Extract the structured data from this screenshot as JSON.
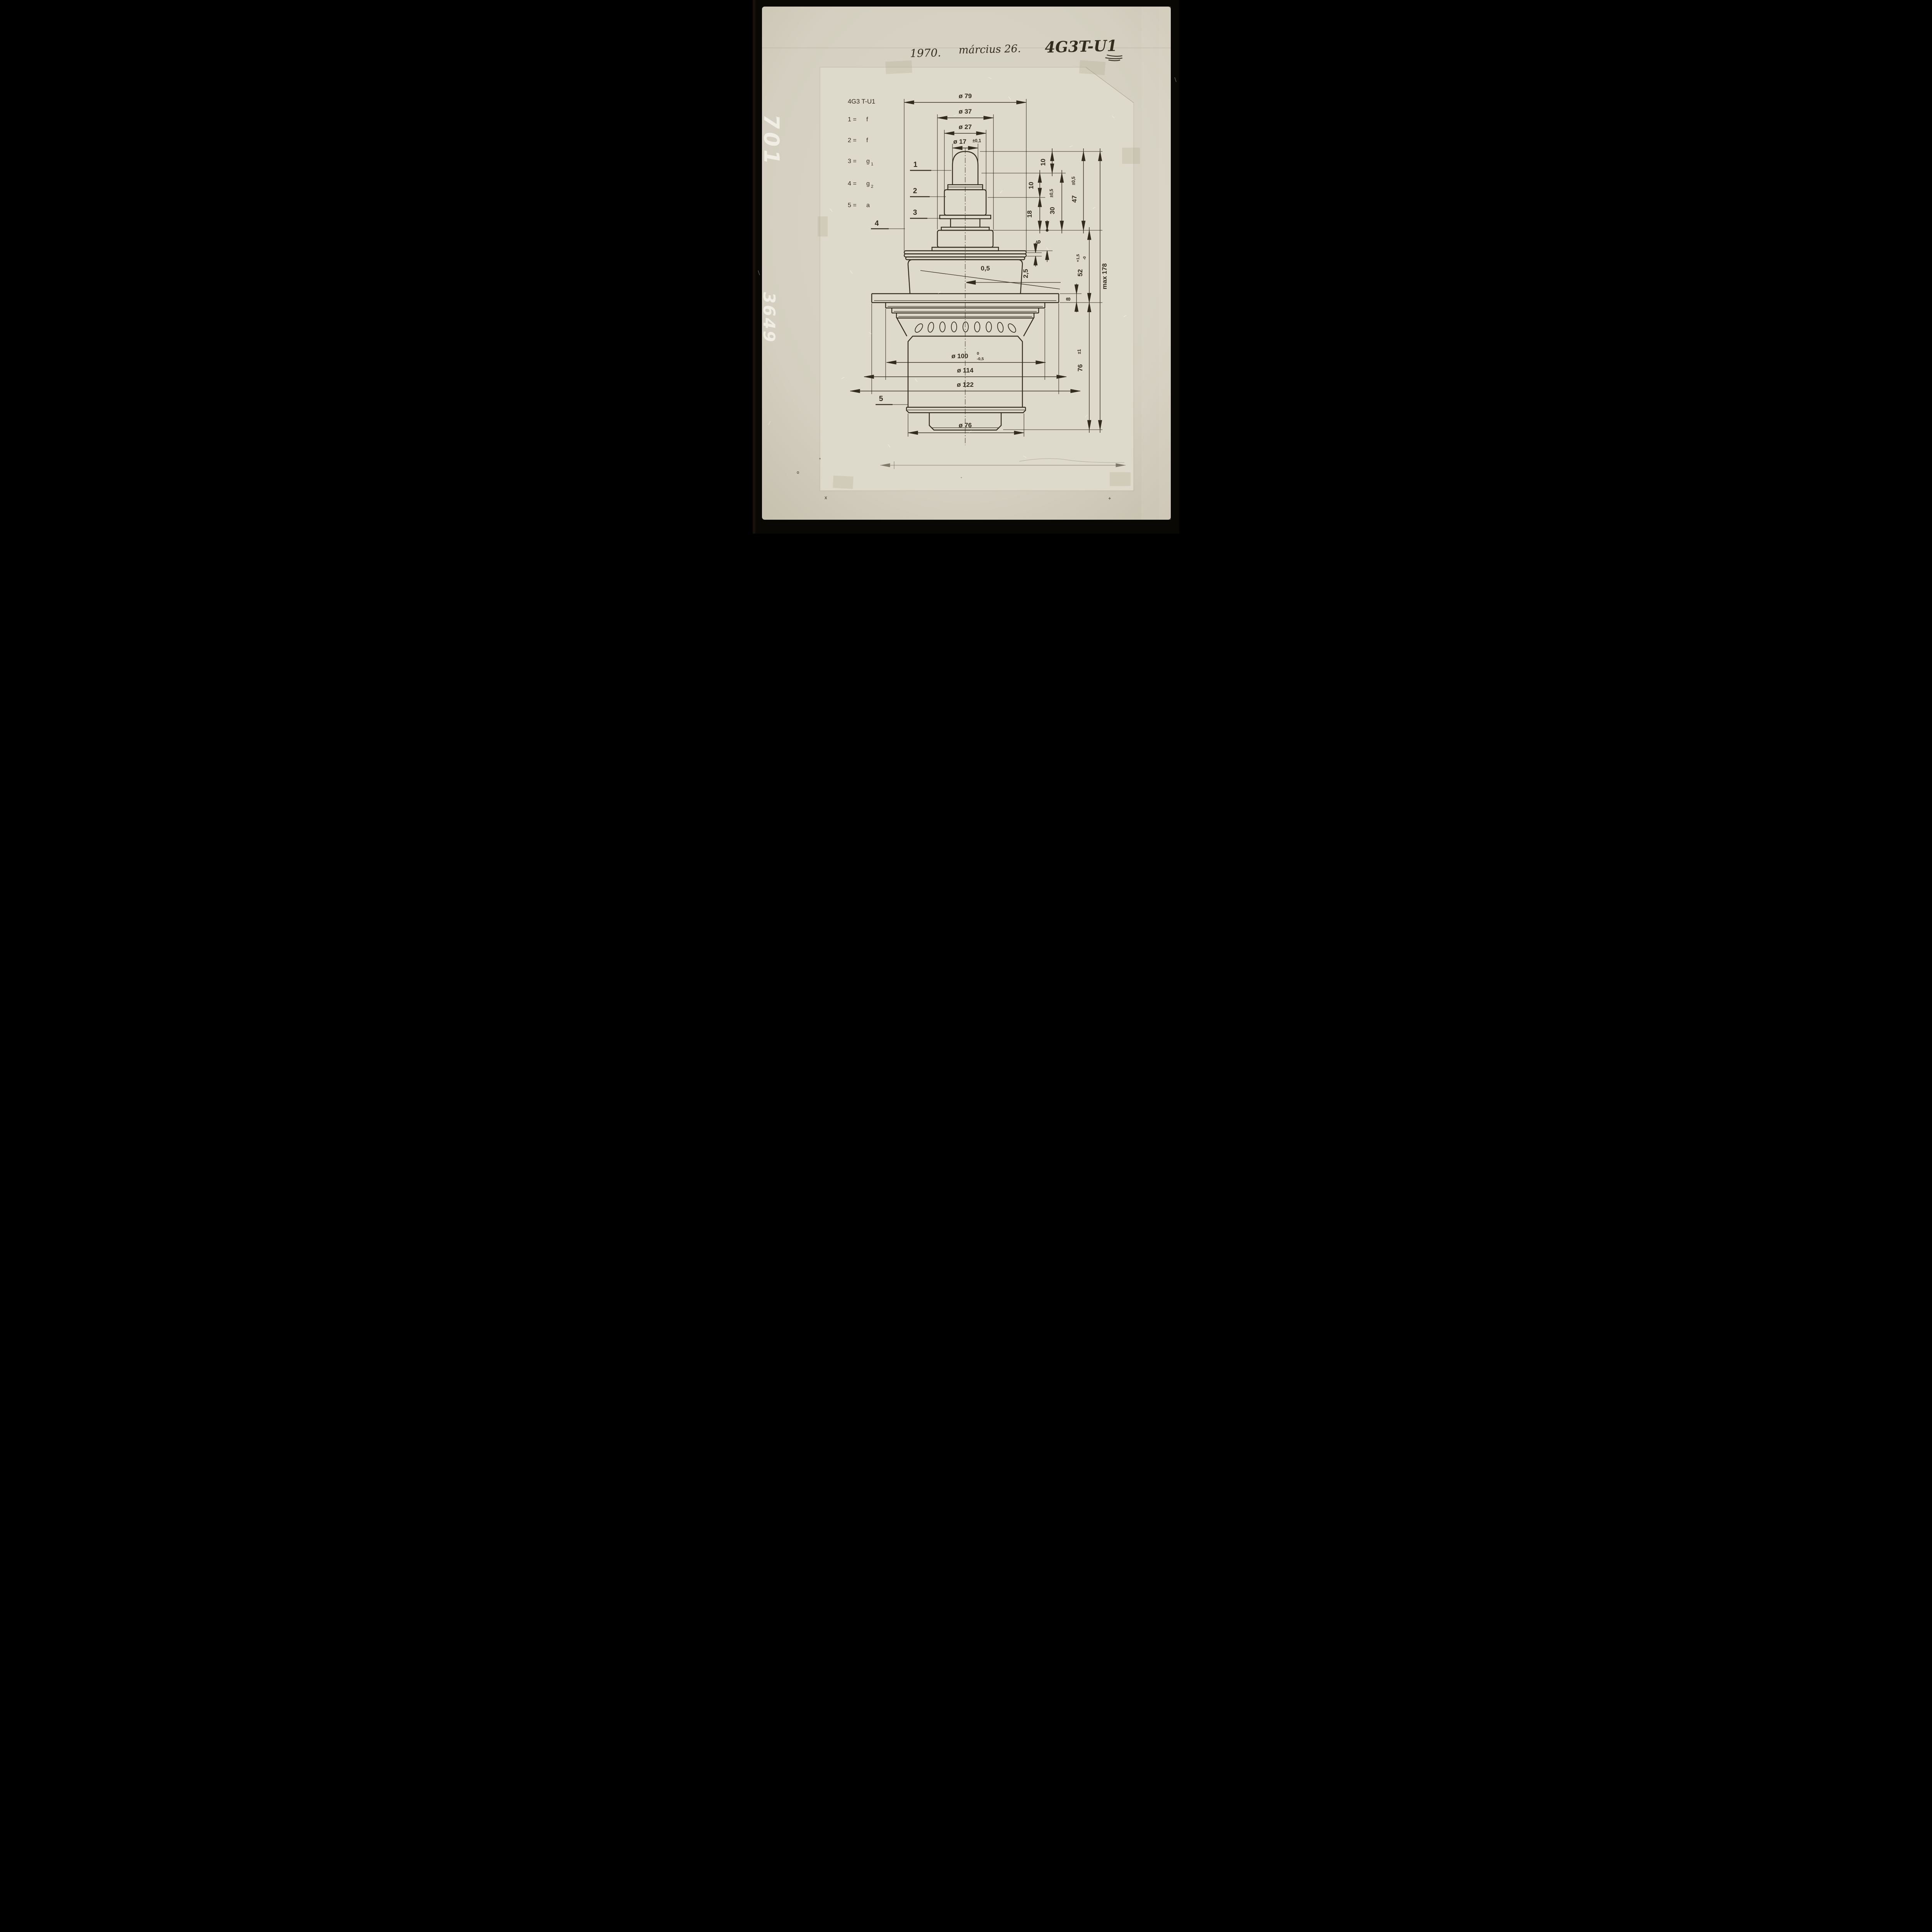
{
  "header": {
    "year": "1970.",
    "date": "március 26.",
    "code": "4G3T-U1"
  },
  "film_edge_code": {
    "part1": "701",
    "part2": "3649"
  },
  "legend": {
    "title": "4G3 T-U1",
    "items": [
      {
        "k": "1 =",
        "v": "f",
        "s": ""
      },
      {
        "k": "2 =",
        "v": "f",
        "s": ""
      },
      {
        "k": "3 =",
        "v": "g",
        "s": "1"
      },
      {
        "k": "4 =",
        "v": "g",
        "s": "2"
      },
      {
        "k": "5 =",
        "v": "a",
        "s": ""
      }
    ]
  },
  "part_labels": [
    "1",
    "2",
    "3",
    "4",
    "5"
  ],
  "dims": {
    "d79": "ø 79",
    "d37": "ø 37",
    "d27": "ø 27",
    "d17": "ø 17",
    "d17tol": "±0,1",
    "d10a": "10",
    "d10b": "10",
    "d18": "18",
    "d30": "30",
    "d30tol": "±0,5",
    "d47": "47",
    "d47tol": "±0,5",
    "d6": "6",
    "d25": "2,5",
    "d05": "0,5",
    "d52": "52",
    "d52sup": "+1,5",
    "d52sub": "-0",
    "dmax": "max 178",
    "d8": "8",
    "d100": "ø 100",
    "d100sup": "0",
    "d100sub": "-0,5",
    "d114": "ø 114",
    "d122": "ø 122",
    "d76v": "76",
    "d76vtol": "±1",
    "d76b": "ø 76"
  },
  "marks": {
    "x": "x",
    "plus": "+",
    "o": "o"
  },
  "colors": {
    "film": "#0a0805",
    "print": "#d6d2c3",
    "sheet": "#dedacb",
    "ink": "#332c1e"
  }
}
